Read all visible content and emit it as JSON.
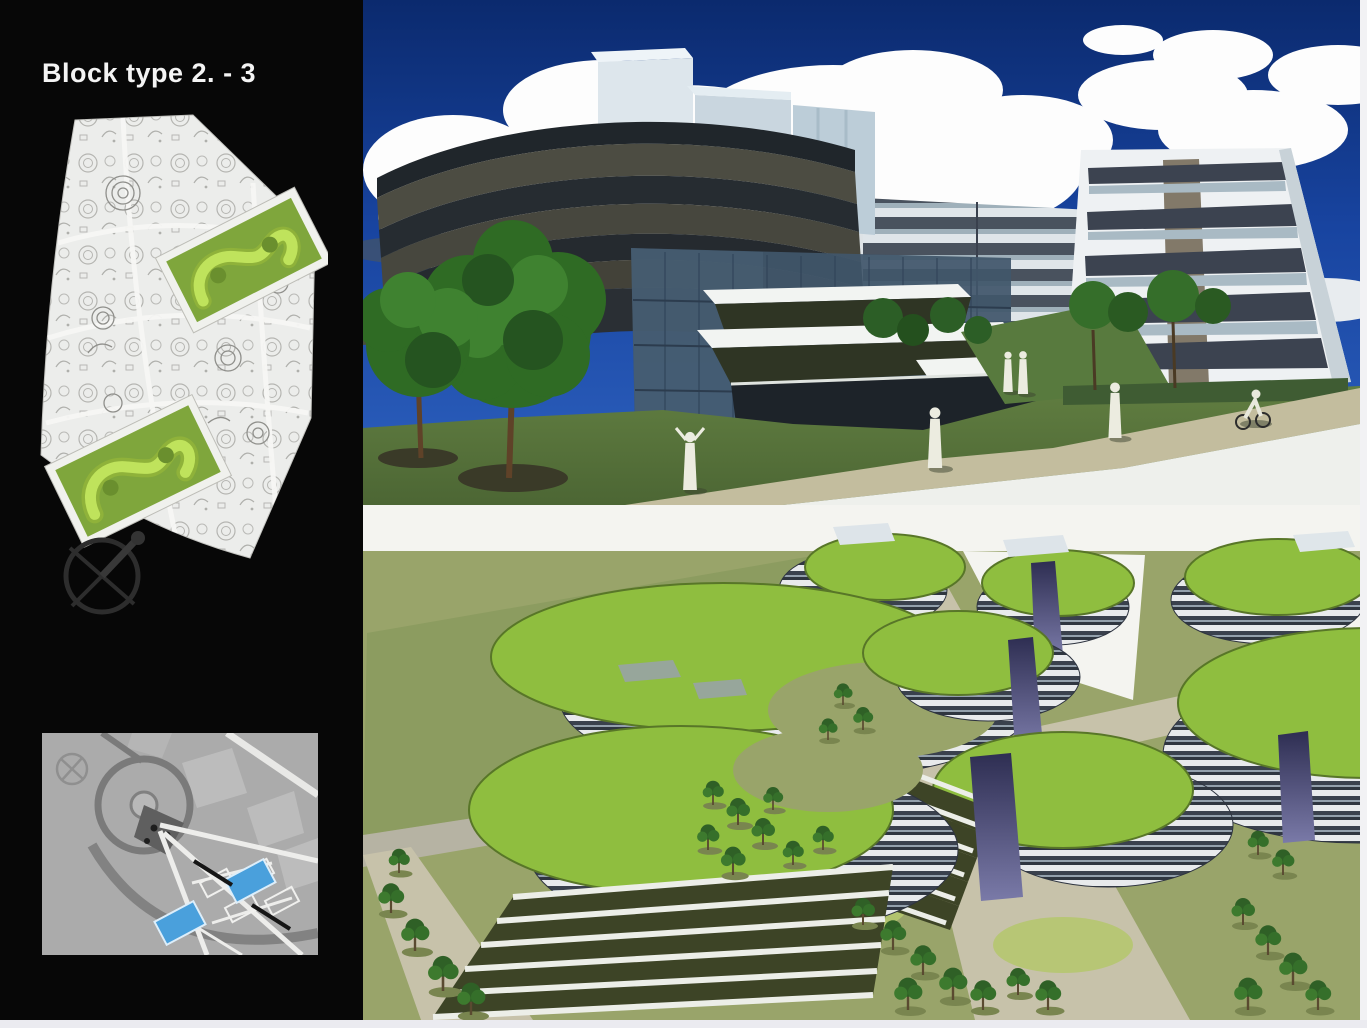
{
  "slide": {
    "title": "Block type 2. - 3"
  },
  "sidebar": {
    "figures": [
      {
        "name": "site-plan",
        "icon": "plan-drawing"
      },
      {
        "name": "north-compass",
        "icon": "compass-icon"
      },
      {
        "name": "location-map",
        "icon": "map",
        "highlighted_parcels": 2
      }
    ]
  },
  "renderings": [
    {
      "name": "street-perspective-rendering"
    },
    {
      "name": "aerial-massing-rendering"
    }
  ],
  "colors": {
    "sidebar_bg": "#070707",
    "title_text": "#f4f4f4",
    "plan_paper": "#ecedeb",
    "plan_block_green": "#7fa63c",
    "plan_building_lime": "#bfe35c",
    "map_bg": "#ababab",
    "map_parcel_blue": "#4aa0dc",
    "sky_blue_top": "#0b2a6e",
    "sky_blue_bottom": "#2e62c0",
    "cloud_white": "#fdfdfd",
    "grass_green": "#5a7740",
    "roof_green": "#8fbe3f",
    "ground_khaki": "#99a46a",
    "road_tan": "#c7c2aa",
    "facade_band_dark": "#3c4350",
    "facade_light": "#eef1f3",
    "accent_purple": "#46466f",
    "frame_light": "#ebebf0"
  }
}
